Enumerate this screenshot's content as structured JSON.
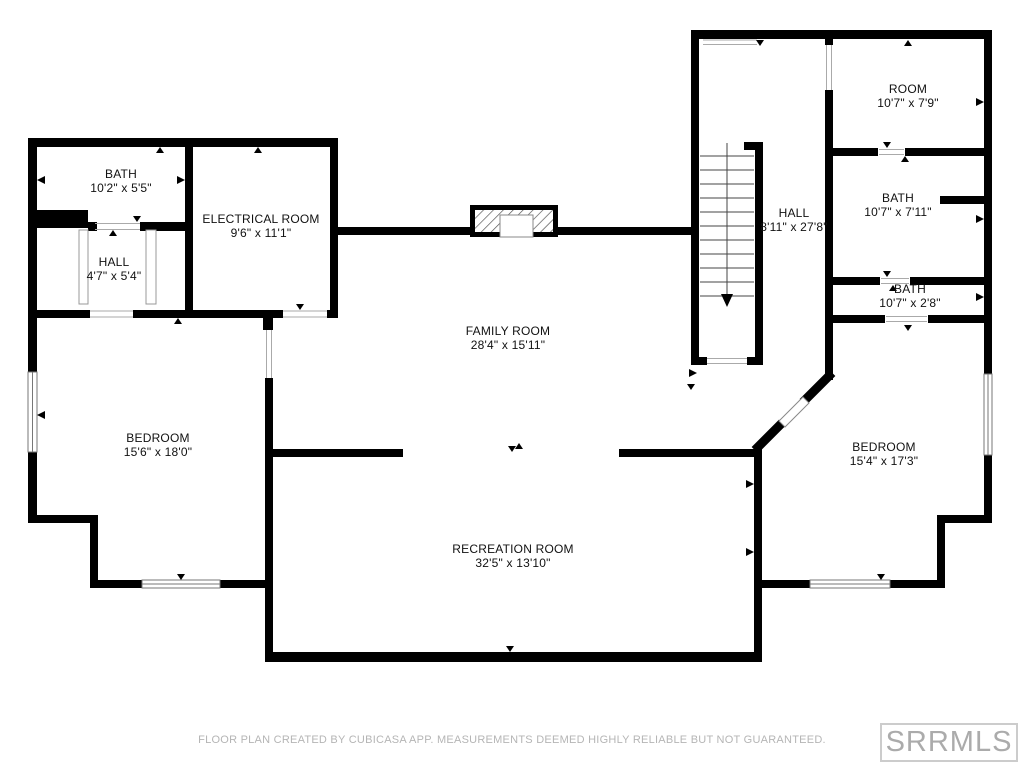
{
  "rooms": [
    {
      "name": "BATH",
      "dims": "10'2\" x 5'5\""
    },
    {
      "name": "ELECTRICAL ROOM",
      "dims": "9'6\" x 11'1\""
    },
    {
      "name": "HALL",
      "dims": "4'7\" x 5'4\""
    },
    {
      "name": "FAMILY ROOM",
      "dims": "28'4\" x 15'11\""
    },
    {
      "name": "ROOM",
      "dims": "10'7\" x 7'9\""
    },
    {
      "name": "HALL",
      "dims": "8'11\" x 27'8\""
    },
    {
      "name": "BATH",
      "dims": "10'7\" x 7'11\""
    },
    {
      "name": "BATH",
      "dims": "10'7\" x 2'8\""
    },
    {
      "name": "BEDROOM",
      "dims": "15'6\" x 18'0\""
    },
    {
      "name": "BEDROOM",
      "dims": "15'4\" x 17'3\""
    },
    {
      "name": "RECREATION ROOM",
      "dims": "32'5\" x 13'10\""
    }
  ],
  "footer": {
    "disclaimer": "FLOOR PLAN CREATED BY CUBICASA APP. MEASUREMENTS DEEMED HIGHLY RELIABLE BUT NOT GUARANTEED."
  },
  "logo": {
    "text": "SRRMLS"
  },
  "colors": {
    "wall": "#000000",
    "label_text": "#111111",
    "muted_text": "#b5b5b5",
    "logo_border": "#cccccc",
    "logo_text": "#ababab",
    "background": "#ffffff"
  }
}
